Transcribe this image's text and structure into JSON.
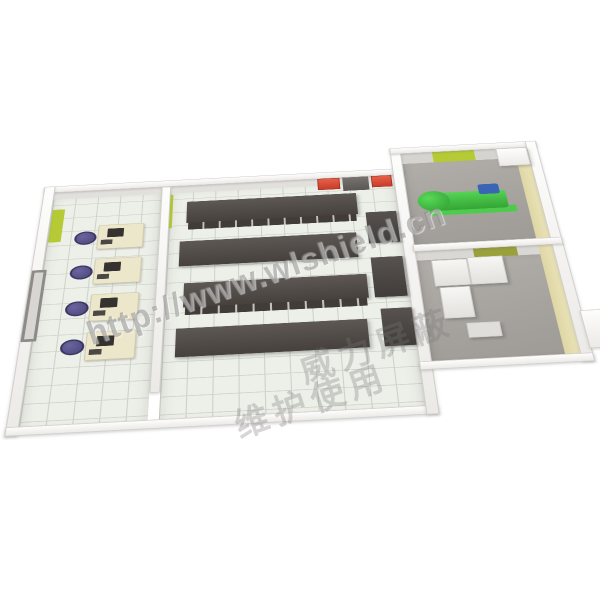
{
  "image": {
    "kind": "3d-floorplan-render",
    "subject": "shielded machine room layout with server hall, office, generator room and UPS room"
  },
  "watermark": {
    "url": "http://www.wlshield.cn",
    "cn_line1": "威力屏蔽",
    "cn_line2": "维护使用"
  },
  "scene": {
    "rooms": [
      {
        "name": "office",
        "workstations": 4
      },
      {
        "name": "server-hall",
        "rack_rows": 4,
        "side_cabinets": 3,
        "wall_red_cabinets": 2
      },
      {
        "name": "generator-room",
        "equipment": "green-generator"
      },
      {
        "name": "ups-room",
        "white_cabinets": 4
      }
    ],
    "colors": {
      "accent_green": "#b5ca35",
      "accent_olive": "#99a03c",
      "rack_dark": "#494440",
      "floor_tile": "#edefe9",
      "annex_floor_gray": "#a8a4a0",
      "wall_white": "#f8f8f6",
      "outer_wall_beige": "#e6dfae",
      "generator_green": "#44c244",
      "engine_blue": "#3a64b4",
      "chair_purple": "#55508a",
      "desk_cream": "#ece6ca",
      "fire_cabinet_red": "#d94b31"
    }
  }
}
